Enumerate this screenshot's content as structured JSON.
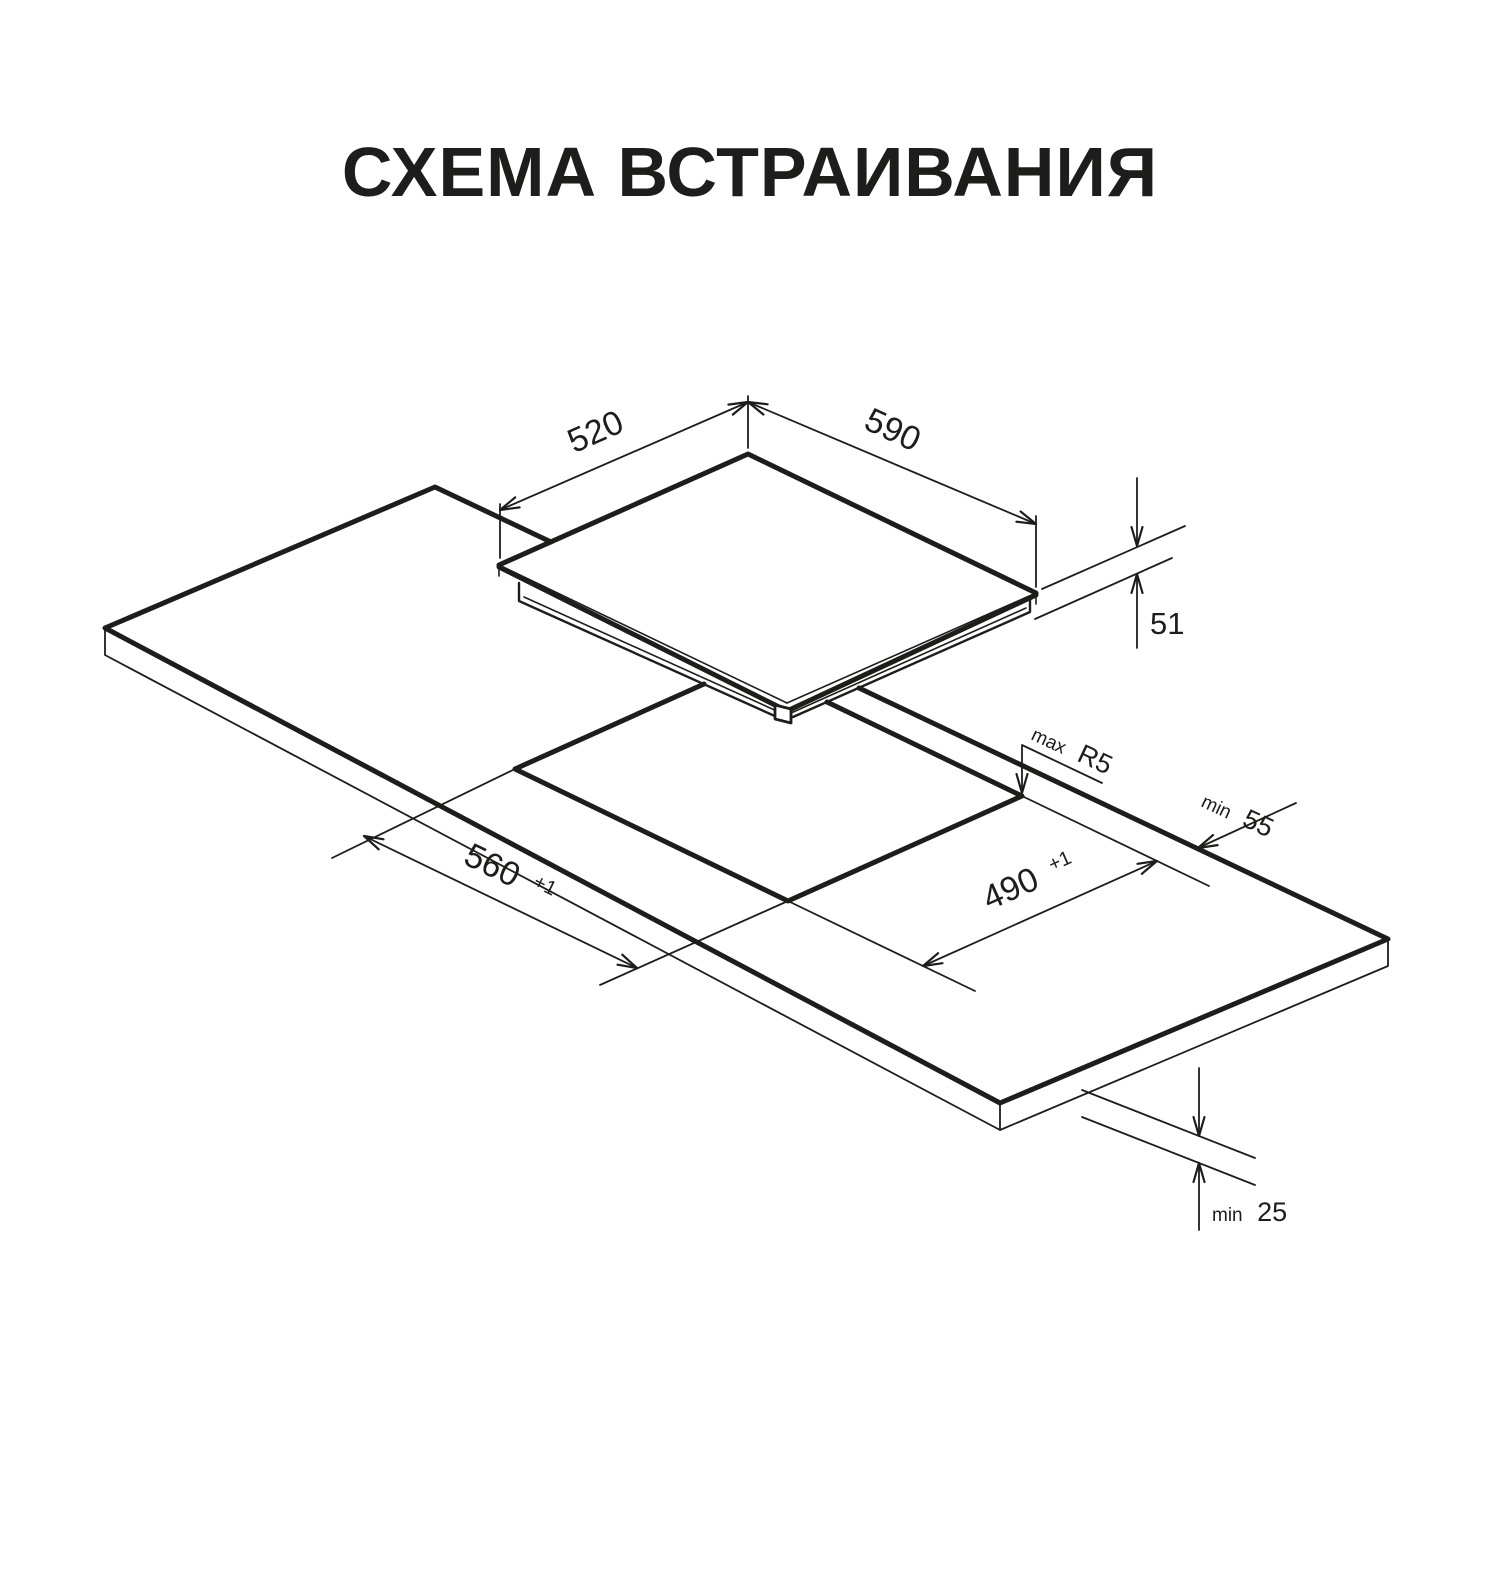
{
  "title": "СХЕМА ВСТРАИВАНИЯ",
  "diagram": {
    "colors": {
      "line": "#1d1d1b",
      "background": "#ffffff"
    },
    "dims": {
      "hob_depth": "520",
      "hob_width": "590",
      "hob_height": "51",
      "cutout_width": "560",
      "cutout_width_tol": "+1",
      "cutout_depth": "490",
      "cutout_depth_tol": "+1",
      "corner_radius_prefix": "max",
      "corner_radius": "R5",
      "rear_clearance_prefix": "min",
      "rear_clearance": "55",
      "bottom_clearance_prefix": "min",
      "bottom_clearance": "25"
    }
  }
}
